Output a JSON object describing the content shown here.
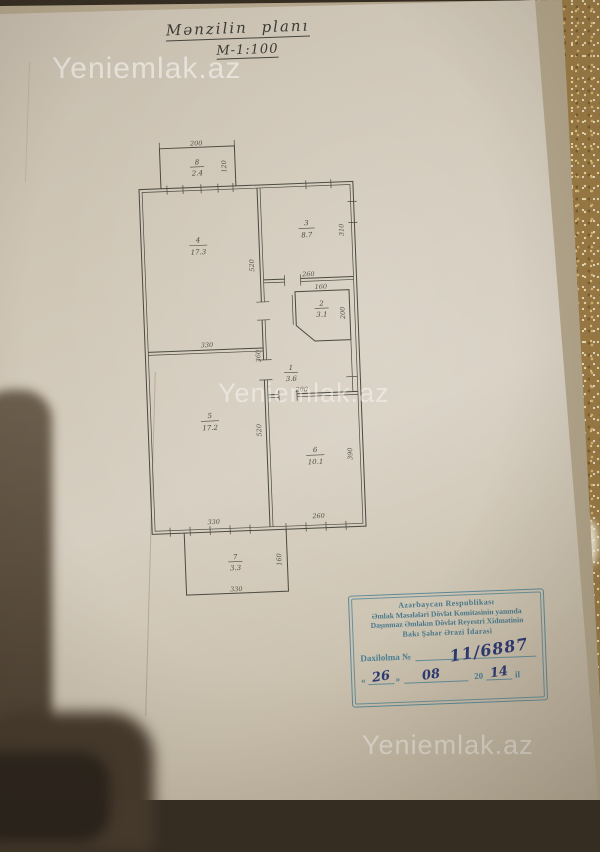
{
  "photo": {
    "watermark_text": "Yeniemlak.az"
  },
  "document": {
    "title": "Mənzilin planı",
    "scale": "M-1:100"
  },
  "plan": {
    "rooms": [
      {
        "number": "1",
        "area": "3.6"
      },
      {
        "number": "2",
        "area": "3.1"
      },
      {
        "number": "3",
        "area": "8.7"
      },
      {
        "number": "4",
        "area": "17.3"
      },
      {
        "number": "5",
        "area": "17.2"
      },
      {
        "number": "6",
        "area": "10.1"
      },
      {
        "number": "7",
        "area": "3.3"
      },
      {
        "number": "8",
        "area": "2.4"
      }
    ],
    "dimensions": {
      "balcony8_width": "200",
      "balcony8_depth": "120",
      "room4_width": "330",
      "room4_height": "520",
      "room3_height": "310",
      "wing_width": "260",
      "room2_width": "160",
      "room2_height": "200",
      "hall_wall": "360",
      "hall_width": "200",
      "room5_width": "330",
      "room5_height": "520",
      "room6_height": "390",
      "room6_width": "260",
      "balcony7_depth": "160",
      "balcony7_width": "330"
    }
  },
  "stamp": {
    "line1": "Azərbaycan Respublikası",
    "line2": "Əmlak Məsələləri Dövlət Komitəsinin yanında",
    "line3": "Daşınmaz Əmlakın Dövlət Reyestri Xidmətinin",
    "line4": "Bakı Şəhər Ərazi İdarəsi",
    "entry_label": "Daxilolma №",
    "entry_number": "11/6887",
    "quote_open": "«",
    "quote_close": "»",
    "date_day": "26",
    "date_month": "08",
    "date_century": "20",
    "date_year": "14",
    "date_suffix": "il"
  },
  "colors": {
    "stamp_blue": "#4a7f93",
    "ink_blue": "#2c3a72",
    "paper": "#cfc6b6",
    "plan_line": "#4b4940",
    "glitter_gold": "#9c7c46"
  }
}
